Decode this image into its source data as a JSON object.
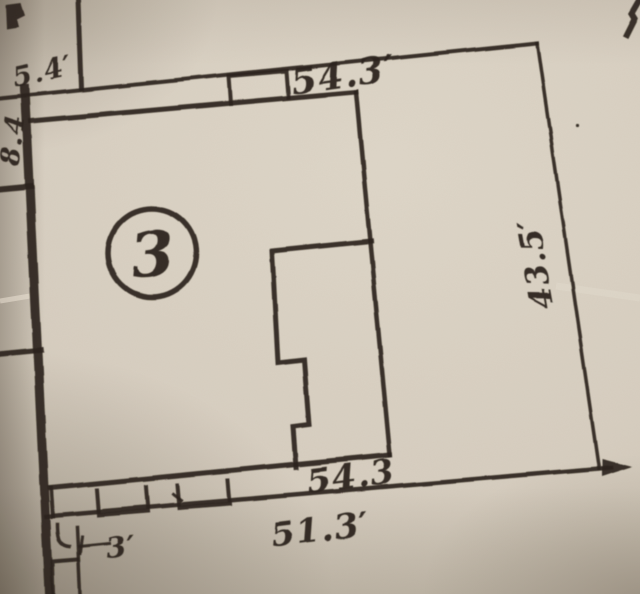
{
  "plat": {
    "kind": "photographed plat / property survey map",
    "parcel_number": "3",
    "labels": {
      "top_offset": "5.4′",
      "left_offset": "8.4",
      "top_width": "54.3′",
      "right_depth": "43.5′",
      "building_width": "54.3",
      "street_width": "51.3′",
      "side_setback": "3′"
    },
    "colors": {
      "paper": "#d7cec0",
      "ink": "#2b241b"
    }
  }
}
